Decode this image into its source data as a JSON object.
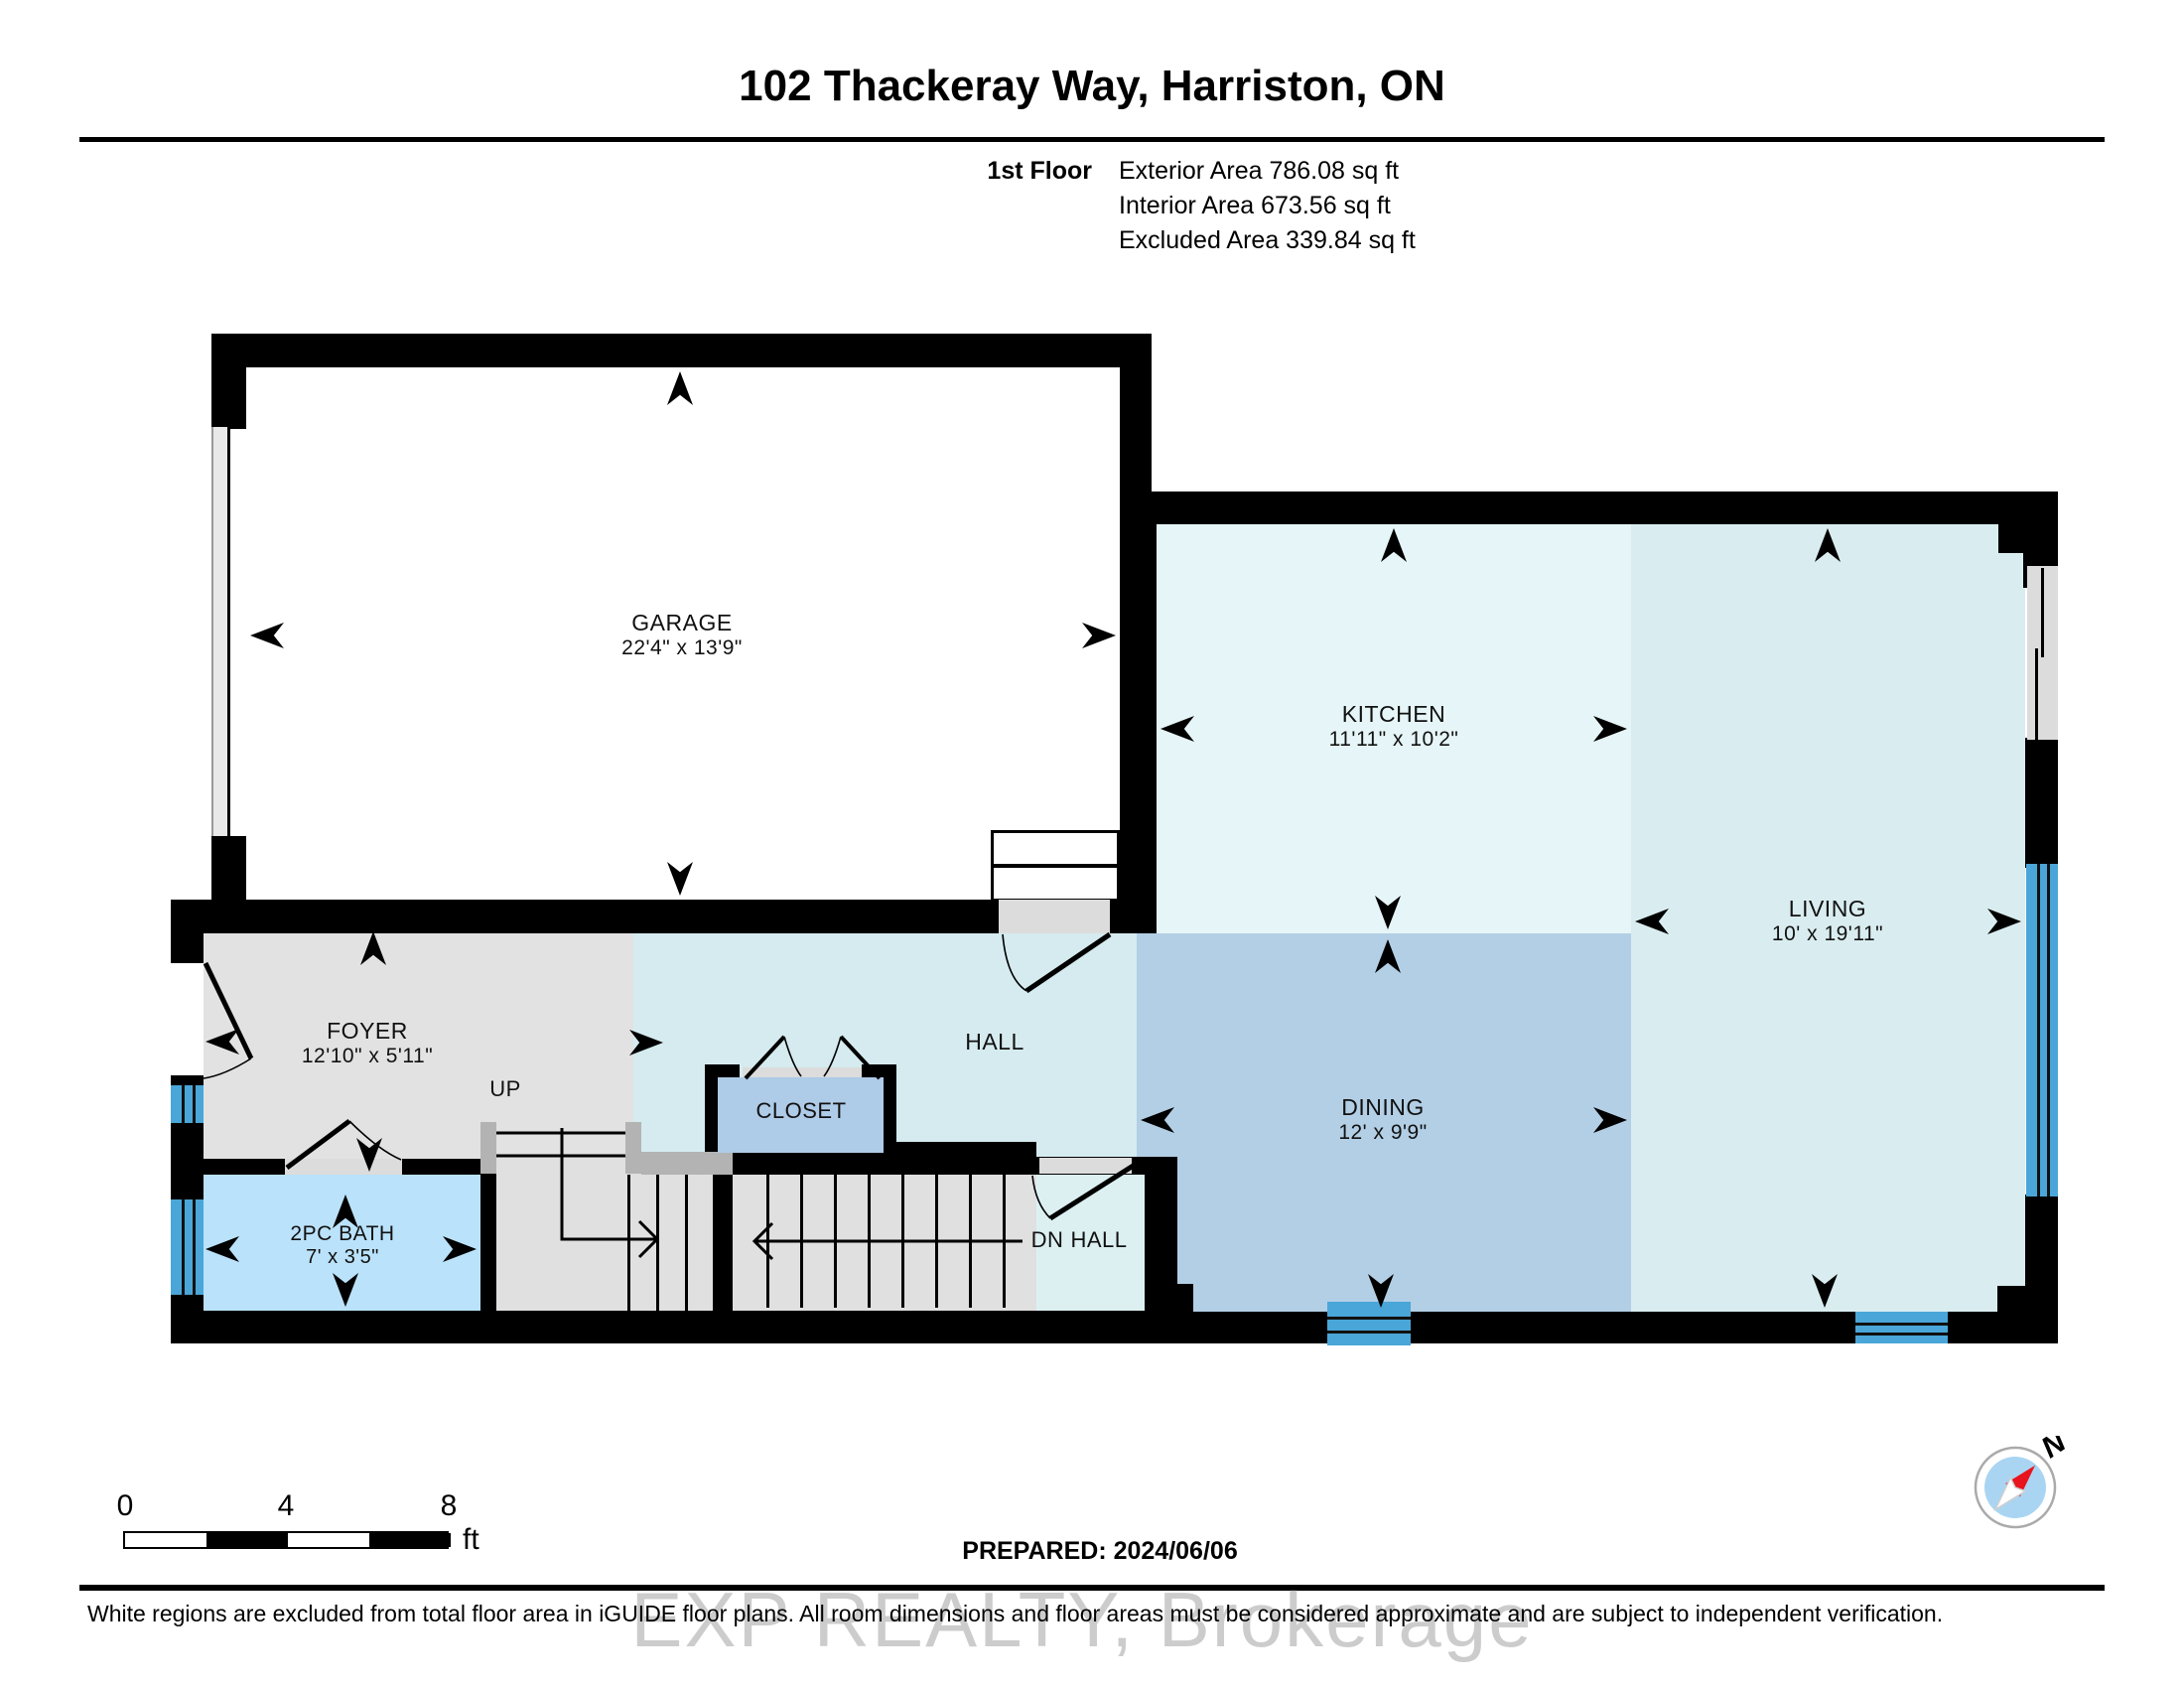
{
  "header": {
    "title": "102 Thackeray Way, Harriston, ON",
    "floor_label": "1st Floor",
    "stats": [
      "Exterior Area 786.08 sq ft",
      "Interior Area 673.56 sq ft",
      "Excluded Area 339.84 sq ft"
    ]
  },
  "rooms": {
    "garage": {
      "name": "GARAGE",
      "dims": "22'4\" x 13'9\""
    },
    "kitchen": {
      "name": "KITCHEN",
      "dims": "11'11\" x 10'2\""
    },
    "living": {
      "name": "LIVING",
      "dims": "10' x 19'11\""
    },
    "dining": {
      "name": "DINING",
      "dims": "12' x 9'9\""
    },
    "foyer": {
      "name": "FOYER",
      "dims": "12'10\" x 5'11\""
    },
    "bath": {
      "name": "2PC BATH",
      "dims": "7' x 3'5\""
    },
    "hall": {
      "name": "HALL"
    },
    "closet": {
      "name": "CLOSET"
    },
    "dn_hall": {
      "dn": "DN",
      "name": "HALL"
    },
    "stairs_up": {
      "name": "UP"
    }
  },
  "footer": {
    "scale": {
      "ticks": [
        "0",
        "4",
        "8"
      ],
      "unit": "ft"
    },
    "prepared": "PREPARED: 2024/06/06",
    "disclaimer": "White regions are excluded from total floor area in iGUIDE floor plans. All room dimensions and floor areas must be considered approximate and are subject to independent verification.",
    "watermark": "EXP REALTY, Brokerage",
    "compass": {
      "label": "N"
    }
  },
  "colors": {
    "wall": "#000000",
    "window": "#4aa6d8",
    "kitchen": "#e6f5f7",
    "living": "#d9edf0",
    "hall": "#d5ebef",
    "dining": "#b3cfe5",
    "closet": "#aecbe8",
    "bath": "#bae2fa",
    "dn_hall": "#dcf0f2",
    "foyer": "#e2e2e2",
    "stairs": "#e0e0e0",
    "door_gray": "#dcdcdc",
    "compass_needle": "#e8141e"
  }
}
